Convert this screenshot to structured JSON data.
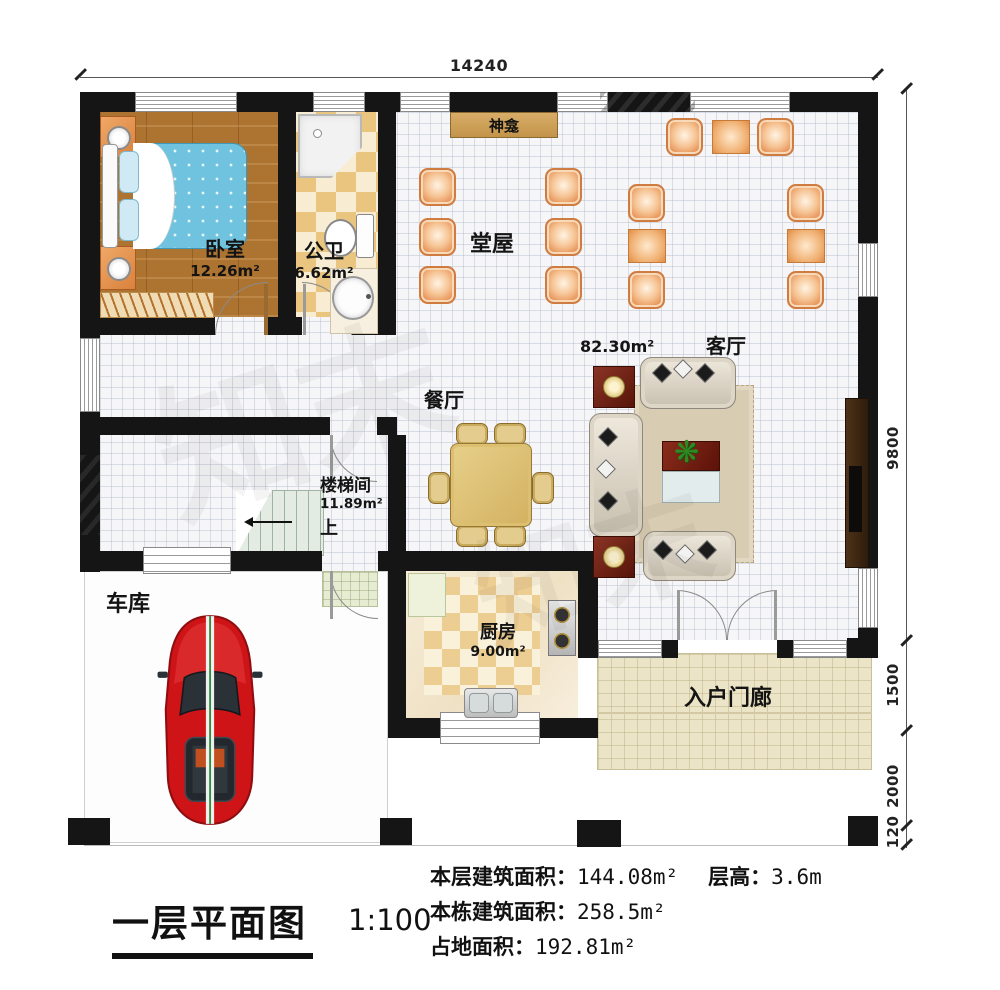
{
  "plan": {
    "dimensions": {
      "top": "14240",
      "right": [
        "9800",
        "1500",
        "2000",
        "120"
      ]
    },
    "rooms": {
      "bedroom": {
        "name": "卧室",
        "area": "12.26m²"
      },
      "bathroom": {
        "name": "公卫",
        "area": "6.62m²"
      },
      "hall": {
        "name": "堂屋"
      },
      "shrine": {
        "name": "神龛"
      },
      "living": {
        "name": "客厅",
        "area": "82.30m²"
      },
      "dining": {
        "name": "餐厅"
      },
      "stairwell": {
        "name": "楼梯间",
        "area": "11.89m²",
        "up": "上"
      },
      "kitchen": {
        "name": "厨房",
        "area": "9.00m²"
      },
      "garage": {
        "name": "车库"
      },
      "porch": {
        "name": "入户门廊"
      }
    },
    "watermark": "知末"
  },
  "footer": {
    "title": "一层平面图",
    "scale": "1:100",
    "stats": [
      {
        "label": "本层建筑面积：",
        "value": "144.08m²",
        "label2": "层高：",
        "value2": "3.6m"
      },
      {
        "label": "本栋建筑面积：",
        "value": "258.5m²"
      },
      {
        "label": "占地面积：",
        "value": "192.81m²"
      }
    ]
  }
}
